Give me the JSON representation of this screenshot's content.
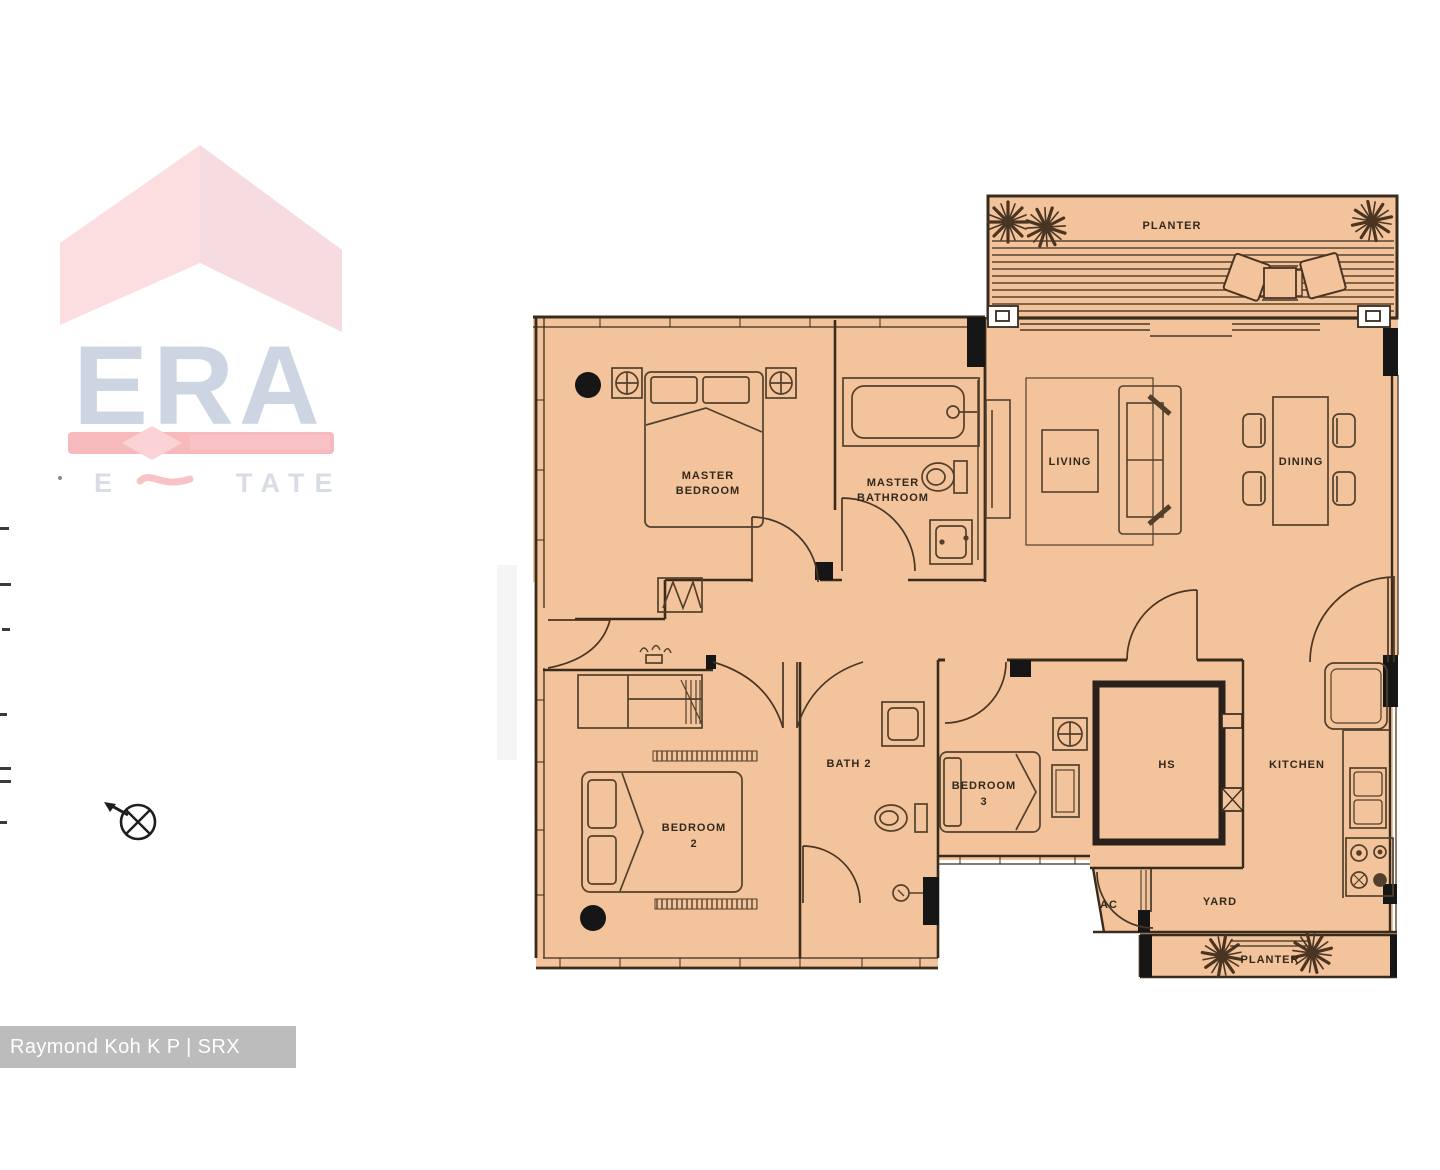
{
  "watermark": {
    "brand": "ERA",
    "estate_left": "E",
    "estate_right": "TATE",
    "attribution": "Raymond Koh K P | SRX PROPERTY"
  },
  "rooms": {
    "planter_top": {
      "label": "PLANTER"
    },
    "living": {
      "label": "LIVING"
    },
    "dining": {
      "label": "DINING"
    },
    "master_bedroom": {
      "line1": "MASTER",
      "line2": "BEDROOM"
    },
    "master_bathroom": {
      "line1": "MASTER",
      "line2": "BATHROOM"
    },
    "bedroom2": {
      "line1": "BEDROOM",
      "line2": "2"
    },
    "bath2": {
      "label": "BATH 2"
    },
    "bedroom3": {
      "line1": "BEDROOM",
      "line2": "3"
    },
    "hs": {
      "label": "HS"
    },
    "kitchen": {
      "label": "KITCHEN"
    },
    "ac": {
      "label": "AC"
    },
    "yard": {
      "label": "YARD"
    },
    "planter_bottom": {
      "label": "PLANTER"
    }
  },
  "colors": {
    "floor_fill": "#f3c49b",
    "wall": "#3a2c1d",
    "era_red_bar": "#f8b9bd",
    "era_letters": "#cdd5e3",
    "era_roof_left": "#fcdee1",
    "era_roof_right": "#f6dbe1",
    "attribution_bg": "#bcbcbc"
  }
}
